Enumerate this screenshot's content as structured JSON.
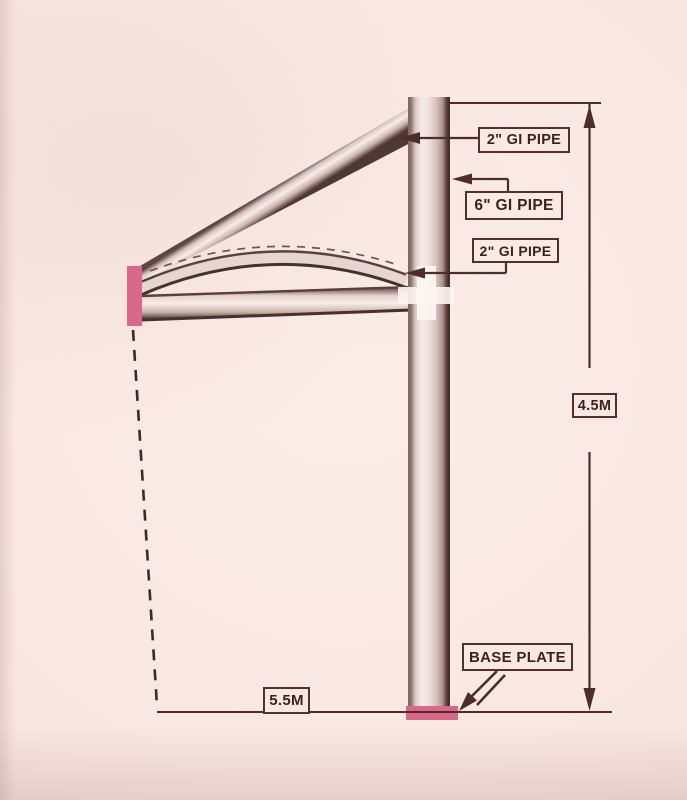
{
  "diagram": {
    "type": "engineering-drawing",
    "subject": "Cantilever canopy structure side elevation",
    "labels": {
      "pipe2_top": "2\" GI PIPE",
      "pipe6": "6\" GI PIPE",
      "pipe2_arch": "2\" GI PIPE",
      "base_plate": "BASE PLATE",
      "height_dim": "4.5M",
      "width_dim": "5.5M"
    },
    "dimensions": {
      "column_height": "4.5M",
      "canopy_projection": "5.5M"
    },
    "colors": {
      "paper": "#f8e6e2",
      "ink": "#4c2d28",
      "plate_pink": "#d9688c"
    }
  }
}
